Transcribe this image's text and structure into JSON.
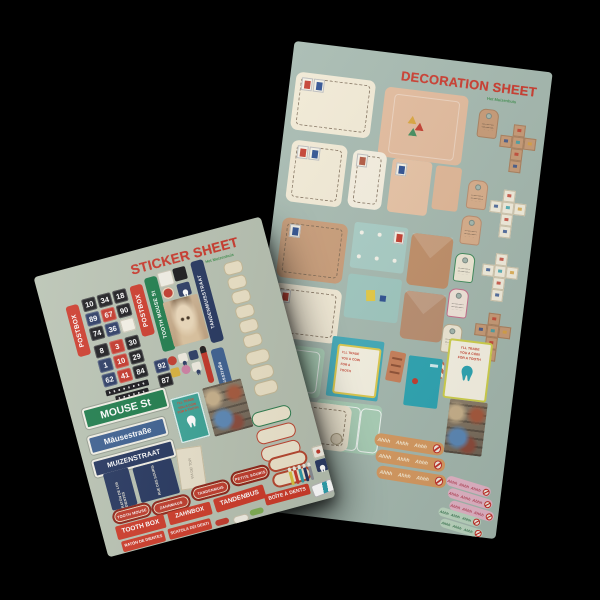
{
  "scene": {
    "background": "#000000"
  },
  "colors": {
    "red": "#ce3a28",
    "maroon": "#8e2418",
    "green_sign": "#1d7c4b",
    "navy": "#24355e",
    "blue_sign": "#3c5f90",
    "teal": "#2ba4b2",
    "teal_soft": "#a6cbc3",
    "mint": "#a9cfb6",
    "kraft": "#c79a75",
    "peach": "#e2ba9b",
    "cream": "#f1e9d4",
    "orange_ticket": "#d6995f",
    "pink_ticket": "#e3b4c6",
    "mint_ticket": "#bcd6c0"
  },
  "sticker_sheet": {
    "title": "STICKER SHEET",
    "subtitle": "Het Muizenhuis",
    "vertical_labels": [
      {
        "text": "POSTBOX",
        "style": "red"
      },
      {
        "text": "POSTBOX",
        "style": "red"
      },
      {
        "text": "TOOTH MOUSE St",
        "style": "green"
      },
      {
        "text": "TANDENMUISSTRAAT",
        "style": "navy"
      },
      {
        "text": "Zahnmausstraße",
        "style": "blue"
      }
    ],
    "number_tiles_a": [
      {
        "n": "10",
        "c": "bk"
      },
      {
        "n": "34",
        "c": "bk"
      },
      {
        "n": "18",
        "c": "bk"
      },
      {
        "n": "89",
        "c": "nv"
      },
      {
        "n": "67",
        "c": "rd"
      },
      {
        "n": "90",
        "c": "bk"
      },
      {
        "n": "74",
        "c": "bk"
      },
      {
        "n": "36",
        "c": "nv"
      },
      {
        "n": "",
        "c": "wh"
      }
    ],
    "number_tiles_b": [
      {
        "n": "8",
        "c": "bk"
      },
      {
        "n": "3",
        "c": "rd"
      },
      {
        "n": "30",
        "c": "bk"
      },
      {
        "n": "1",
        "c": "nv"
      },
      {
        "n": "10",
        "c": "rd"
      },
      {
        "n": "29",
        "c": "bk"
      },
      {
        "n": "62",
        "c": "nv"
      },
      {
        "n": "41",
        "c": "rd"
      },
      {
        "n": "84",
        "c": "bk"
      }
    ],
    "loose_tiles": [
      {
        "n": "92",
        "c": "nv"
      },
      {
        "n": "87",
        "c": "bk"
      }
    ],
    "street_signs": [
      {
        "text": "MOUSE St",
        "style": "green"
      },
      {
        "text": "Mäusestraße",
        "style": "blue"
      },
      {
        "text": "MUIZENSTRAAT",
        "style": "navy"
      }
    ],
    "navy_panels": [
      {
        "text": "RATÓN DE LOS DIENTES"
      },
      {
        "text": "RUE DES SOURIS"
      }
    ],
    "paper_slip": {
      "text": "VIA DEI TOPI"
    },
    "tooth_card": {
      "lines": [
        "I'LL TRADE",
        "YOU A COIN",
        "FOR A TOOTH"
      ]
    },
    "oval_labels": [
      {
        "text": "TOOTH MOUSE"
      },
      {
        "text": "ZAHNMAUS"
      },
      {
        "text": "TANDENMUIS"
      },
      {
        "text": "PETITE SOURIS"
      }
    ],
    "box_labels": [
      {
        "text": "TOOTH BOX"
      },
      {
        "text": "ZAHNBOX"
      },
      {
        "text": "TANDENBUS"
      },
      {
        "text": "BOÎTE À DENTS"
      },
      {
        "text": "RATÓN DE DIENTES"
      },
      {
        "text": "SCATOLA DEI DENTI"
      }
    ]
  },
  "decoration_sheet": {
    "title": "DECORATION SHEET",
    "subtitle": "Het Muizenhuis",
    "tooth_card": {
      "lines": [
        "I'LL TRADE",
        "YOU A COIN",
        "FOR A TOOTH"
      ]
    },
    "trade_card": {
      "lines": [
        "I'LL TRADE",
        "YOU A COIN",
        "FOR A",
        "TOOTH"
      ]
    },
    "ticket_text": "Ahhh"
  }
}
